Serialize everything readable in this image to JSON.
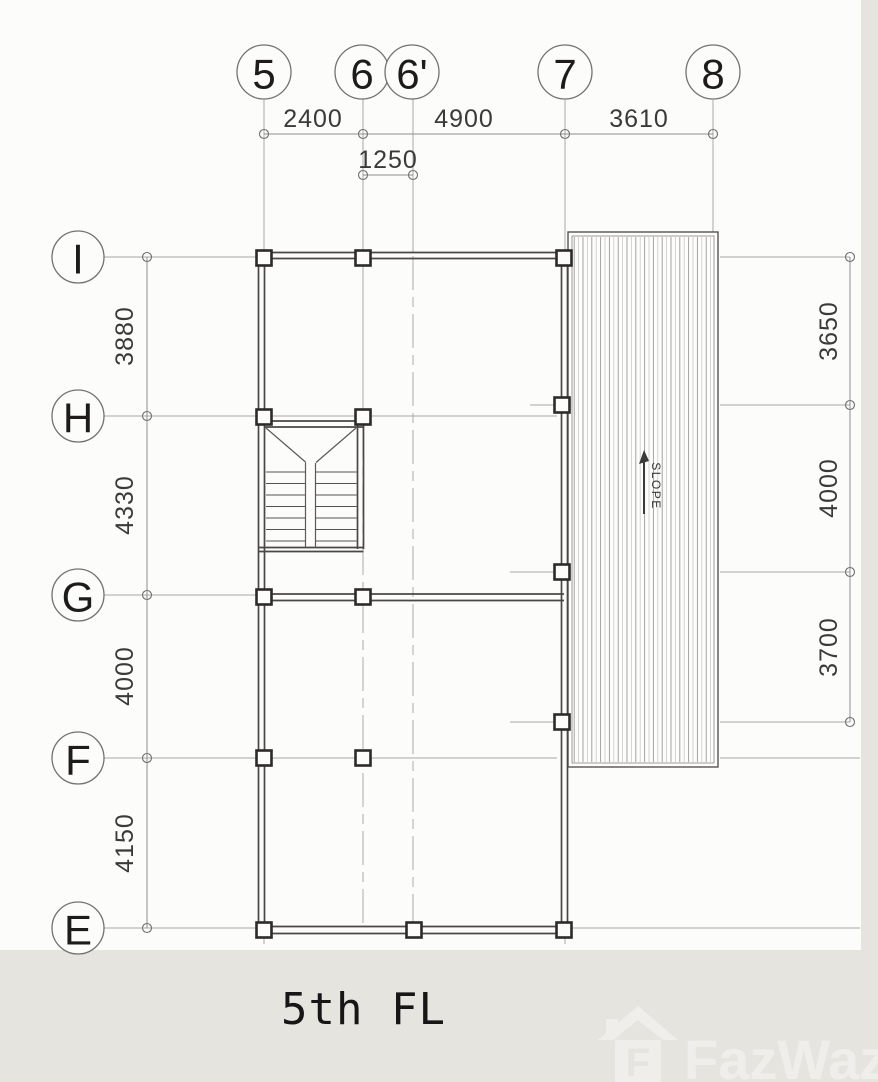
{
  "title": "5th FL",
  "grid": {
    "top_labels": [
      "5",
      "6",
      "6'",
      "7",
      "8"
    ],
    "left_labels": [
      "I",
      "H",
      "G",
      "F",
      "E"
    ]
  },
  "dimensions": {
    "top": [
      "2400",
      "4900",
      "3610"
    ],
    "top_sub": "1250",
    "left": [
      "3880",
      "4330",
      "4000",
      "4150"
    ],
    "right": [
      "3650",
      "4000",
      "3700"
    ]
  },
  "annotations": {
    "slope": "SLOPE"
  },
  "watermark": {
    "brand": "FazWaz",
    "icon_letter": "F"
  },
  "colors": {
    "background": "#e6e4df",
    "paper": "#fcfcfa",
    "wall": "#4a4846",
    "grid_line": "#a8a8a6",
    "dim_text": "#3a3a38",
    "watermark": "#f3f1ed"
  }
}
